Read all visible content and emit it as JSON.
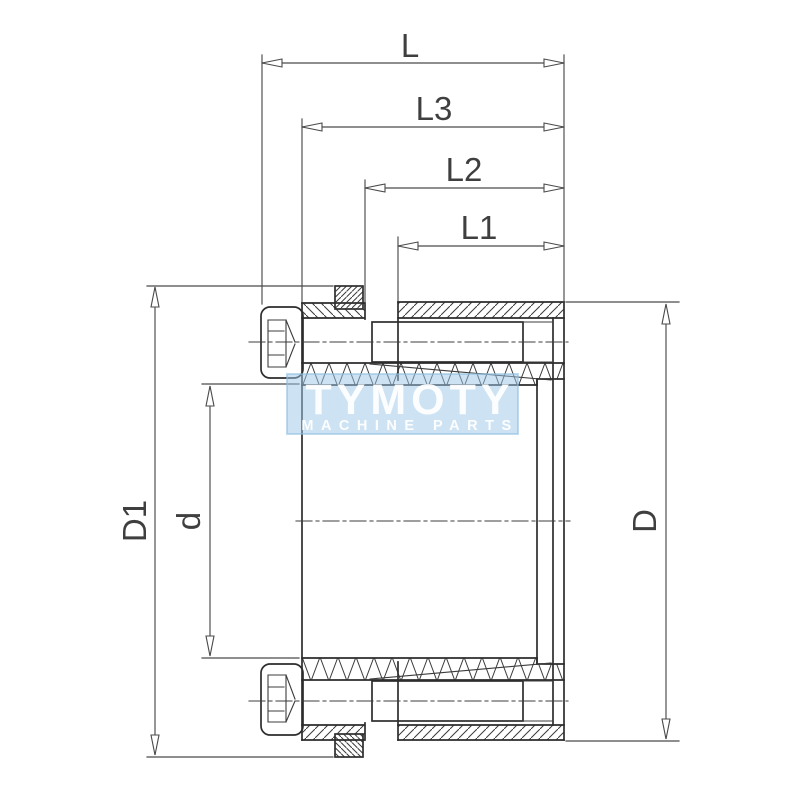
{
  "page": {
    "background": "#ffffff"
  },
  "drawing": {
    "type": "technical-cross-section-locking-assembly",
    "labels": {
      "L": "L",
      "L3": "L3",
      "L2": "L2",
      "L1": "L1",
      "D1": "D1",
      "d": "d",
      "D": "D"
    },
    "watermark": {
      "title": "TYMOTY",
      "subtitle": "MACHINE PARTS",
      "box_color": "#9cc8e8",
      "box_opacity": "0.5",
      "text_color": "#ffffff"
    },
    "colors": {
      "outline": "#2d2d2d",
      "hatch": "#3a3a3a",
      "dimension": "#4a4a4a",
      "label": "#3f3f3f"
    }
  }
}
